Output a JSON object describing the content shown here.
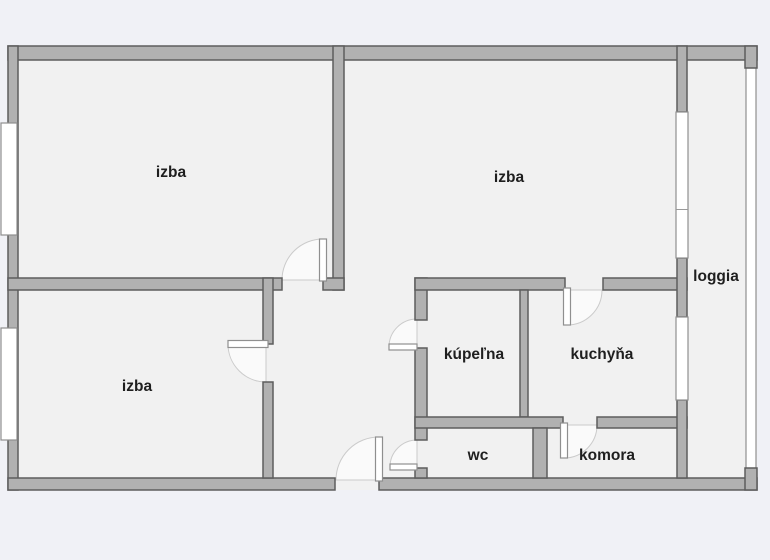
{
  "plan": {
    "type": "apartment-floor-plan",
    "colors": {
      "background": "#f0f1f6",
      "room_fill": "#f1f1f1",
      "wall_fill": "#b1b1b1",
      "wall_outline": "#5d5d5d",
      "window_fill": "#ffffff",
      "label_color": "#1f1f1f"
    },
    "rooms": [
      {
        "id": "izba-top-left",
        "label": "izba"
      },
      {
        "id": "izba-top-right",
        "label": "izba"
      },
      {
        "id": "izba-bottom-left",
        "label": "izba"
      },
      {
        "id": "kupelna",
        "label": "kúpeľna"
      },
      {
        "id": "kuchyna",
        "label": "kuchyňa"
      },
      {
        "id": "wc",
        "label": "wc"
      },
      {
        "id": "komora",
        "label": "komora"
      },
      {
        "id": "loggia",
        "label": "loggia"
      }
    ]
  }
}
